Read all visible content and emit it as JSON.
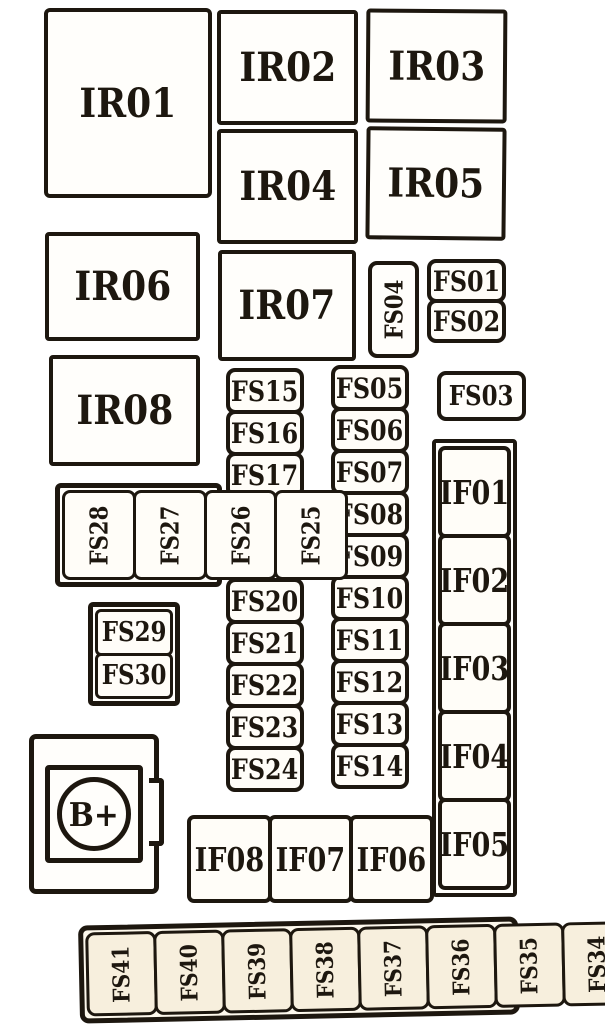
{
  "colors": {
    "ink": "#1d170f",
    "paper": "#ffffff",
    "aged_cell": "#f7efdd"
  },
  "relays": {
    "ir01": "IR01",
    "ir02": "IR02",
    "ir03": "IR03",
    "ir04": "IR04",
    "ir05": "IR05",
    "ir06": "IR06",
    "ir07": "IR07",
    "ir08": "IR08"
  },
  "fuses": {
    "fs01": "FS01",
    "fs02": "FS02",
    "fs03": "FS03",
    "fs04": "FS04"
  },
  "stack_fs01_02": {
    "items": [
      "FS01",
      "FS02"
    ]
  },
  "column_left": {
    "items": [
      "FS15",
      "FS16",
      "FS17",
      "FS18",
      "FS19",
      "FS20",
      "FS21",
      "FS22",
      "FS23",
      "FS24"
    ]
  },
  "column_right": {
    "items": [
      "FS05",
      "FS06",
      "FS07",
      "FS08",
      "FS09",
      "FS10",
      "FS11",
      "FS12",
      "FS13",
      "FS14"
    ]
  },
  "if_column": {
    "items": [
      "IF01",
      "IF02",
      "IF03",
      "IF04",
      "IF05"
    ]
  },
  "if_row": {
    "items": [
      "IF08",
      "IF07",
      "IF06"
    ]
  },
  "group_fs28_25": {
    "items": [
      "FS28",
      "FS27",
      "FS26",
      "FS25"
    ]
  },
  "group_fs29_30": {
    "items": [
      "FS29",
      "FS30"
    ]
  },
  "battery": {
    "label": "B+"
  },
  "bottom_strip": {
    "items": [
      "FS41",
      "FS40",
      "FS39",
      "FS38",
      "FS37",
      "FS36",
      "FS35",
      "FS34",
      "FS33",
      "FS32",
      "FS31"
    ]
  }
}
